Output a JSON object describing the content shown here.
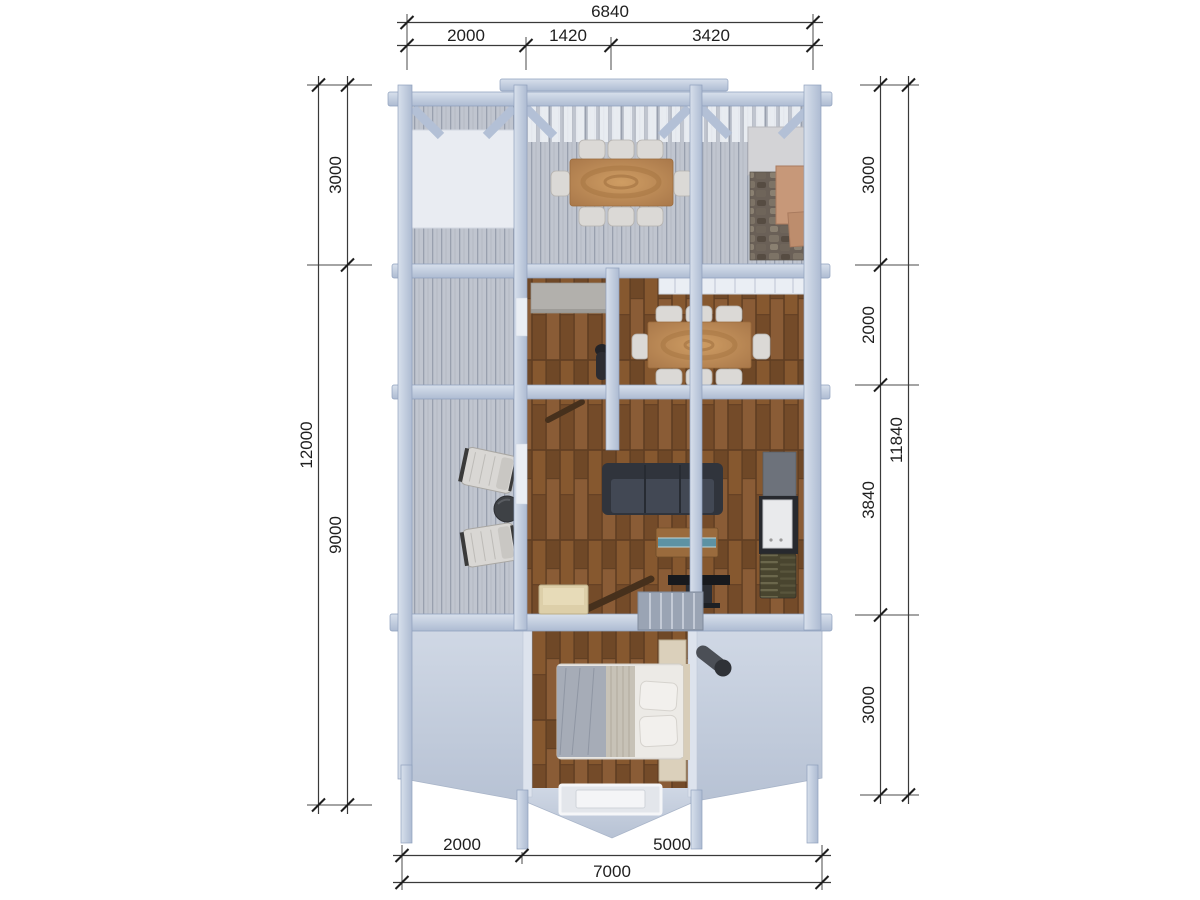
{
  "drawing": {
    "type": "3d-floor-plan-top-view",
    "background": "#ffffff"
  },
  "dimensions": {
    "top": {
      "total": "6840",
      "segments": [
        "2000",
        "1420",
        "3420"
      ]
    },
    "left": {
      "total": "12000",
      "segments": [
        "3000",
        "9000"
      ]
    },
    "right": {
      "total": "11840",
      "segments": [
        "3000",
        "2000",
        "3840",
        "3000"
      ]
    },
    "bottom": {
      "total": "7000",
      "segments": [
        "2000",
        "5000"
      ]
    }
  },
  "palette": {
    "frame_wood": "#b9c5da",
    "frame_light": "#d8e0ec",
    "deck_planks": "#c0c5cf",
    "interior_wood_floor": "#7d5230",
    "table_wood": "#b9854f",
    "sofa": "#3b4049",
    "bed_blanket": "#a6acb7",
    "bed_sheets": "#eceae6",
    "stone_grill": "#6a6057",
    "copper_hood": "#c79879",
    "roof": "#c6cfdd",
    "dimension_lines": "#3a3a3a",
    "dimension_text": "#1f1f1f"
  }
}
